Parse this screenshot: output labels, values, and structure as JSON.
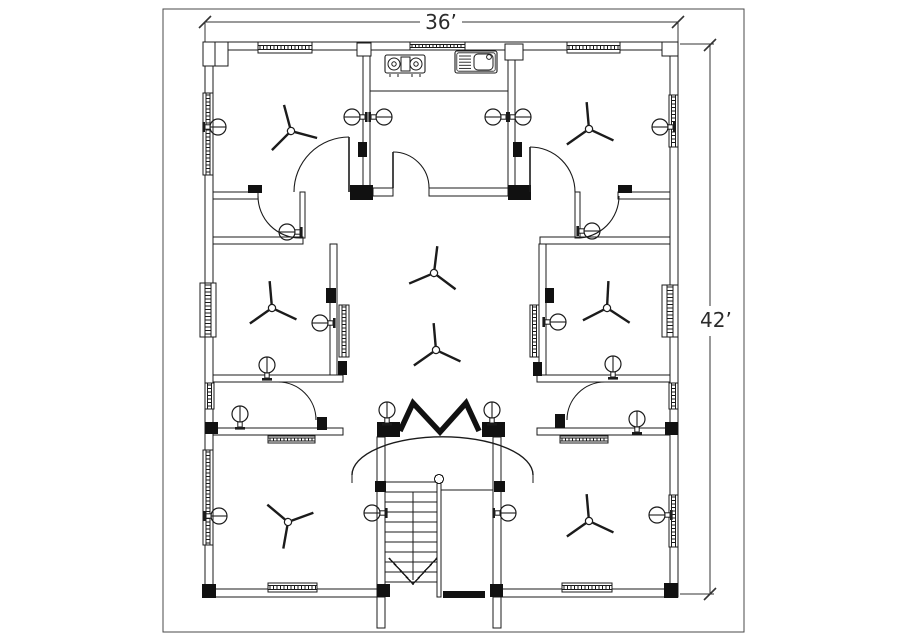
{
  "title": "Floor plan drawing",
  "dimensions": {
    "width_label": "36’",
    "height_label": "42’"
  },
  "colors": {
    "line": "#1b1b1b",
    "dim": "#333333",
    "border": "#4a4a4a",
    "fill": "#ffffff",
    "block": "#111111"
  },
  "plan": {
    "border": [
      163,
      9,
      581,
      623
    ],
    "dim_segments": [
      [
        205,
        22,
        420,
        22
      ],
      [
        462,
        22,
        678,
        22
      ],
      [
        710,
        45,
        710,
        306
      ],
      [
        710,
        336,
        710,
        594
      ]
    ],
    "dim_ticks": [
      [
        205,
        22
      ],
      [
        678,
        22
      ],
      [
        710,
        45
      ],
      [
        710,
        594
      ]
    ],
    "ext_lines": [
      [
        205,
        22,
        205,
        45
      ],
      [
        678,
        22,
        678,
        45
      ],
      [
        680,
        44,
        714,
        44
      ],
      [
        680,
        594,
        714,
        594
      ]
    ],
    "width_label_pos": [
      441,
      29
    ],
    "height_label_pos": [
      700,
      327
    ],
    "walls": [
      [
        205,
        42,
        473,
        8
      ],
      [
        205,
        589,
        180,
        8
      ],
      [
        493,
        589,
        185,
        8
      ],
      [
        205,
        42,
        8,
        555
      ],
      [
        670,
        42,
        8,
        555
      ],
      [
        363,
        50,
        7,
        138
      ],
      [
        508,
        50,
        7,
        138
      ],
      [
        373,
        188,
        20,
        8
      ],
      [
        429,
        188,
        79,
        8
      ],
      [
        213,
        192,
        45,
        7
      ],
      [
        618,
        192,
        52,
        7
      ],
      [
        300,
        192,
        5,
        46
      ],
      [
        575,
        192,
        5,
        46
      ],
      [
        213,
        237,
        90,
        7
      ],
      [
        540,
        237,
        130,
        7
      ],
      [
        330,
        244,
        7,
        131
      ],
      [
        539,
        244,
        7,
        131
      ],
      [
        213,
        375,
        130,
        7
      ],
      [
        537,
        375,
        133,
        7
      ],
      [
        213,
        428,
        130,
        7
      ],
      [
        537,
        428,
        133,
        7
      ],
      [
        377,
        437,
        8,
        160
      ],
      [
        493,
        437,
        8,
        160
      ],
      [
        377,
        597,
        8,
        31
      ],
      [
        493,
        597,
        8,
        31
      ],
      [
        437,
        479,
        4,
        118
      ]
    ],
    "lines": [
      [
        370,
        91,
        508,
        91
      ],
      [
        441,
        490,
        493,
        490
      ],
      [
        413,
        492,
        413,
        580
      ],
      [
        352,
        475,
        352,
        483
      ],
      [
        533,
        475,
        533,
        483
      ]
    ],
    "blocks": [
      [
        350,
        185,
        23,
        15
      ],
      [
        508,
        185,
        23,
        15
      ],
      [
        377,
        422,
        23,
        15
      ],
      [
        482,
        422,
        23,
        15
      ],
      [
        317,
        417,
        10,
        13
      ],
      [
        555,
        414,
        10,
        14
      ],
      [
        326,
        288,
        10,
        15
      ],
      [
        545,
        288,
        9,
        15
      ],
      [
        338,
        361,
        9,
        14
      ],
      [
        533,
        362,
        9,
        14
      ],
      [
        205,
        422,
        13,
        12
      ],
      [
        665,
        422,
        13,
        13
      ],
      [
        375,
        481,
        11,
        11
      ],
      [
        494,
        481,
        11,
        11
      ],
      [
        377,
        584,
        13,
        13
      ],
      [
        490,
        584,
        13,
        13
      ],
      [
        202,
        584,
        14,
        14
      ],
      [
        664,
        583,
        14,
        15
      ],
      [
        443,
        591,
        42,
        7
      ],
      [
        358,
        142,
        9,
        15
      ],
      [
        513,
        142,
        9,
        15
      ],
      [
        248,
        185,
        14,
        8
      ],
      [
        618,
        185,
        14,
        8
      ]
    ],
    "hollows": [
      [
        203,
        42,
        25,
        24
      ],
      [
        357,
        43,
        14,
        13
      ],
      [
        505,
        44,
        18,
        16
      ],
      [
        662,
        42,
        16,
        14
      ]
    ],
    "windows": [
      {
        "r": [
          258,
          42,
          54,
          11
        ],
        "o": "h"
      },
      {
        "r": [
          410,
          42,
          55,
          8
        ],
        "o": "h"
      },
      {
        "r": [
          567,
          42,
          53,
          11
        ],
        "o": "h"
      },
      {
        "r": [
          268,
          583,
          49,
          9
        ],
        "o": "h"
      },
      {
        "r": [
          562,
          583,
          50,
          9
        ],
        "o": "h"
      },
      {
        "r": [
          268,
          436,
          47,
          7
        ],
        "o": "h"
      },
      {
        "r": [
          560,
          436,
          48,
          7
        ],
        "o": "h"
      },
      {
        "r": [
          203,
          93,
          10,
          82
        ],
        "o": "v"
      },
      {
        "r": [
          200,
          283,
          16,
          54
        ],
        "o": "v"
      },
      {
        "r": [
          203,
          450,
          10,
          95
        ],
        "o": "v"
      },
      {
        "r": [
          205,
          383,
          9,
          26
        ],
        "o": "v"
      },
      {
        "r": [
          669,
          95,
          9,
          52
        ],
        "o": "v"
      },
      {
        "r": [
          662,
          285,
          16,
          52
        ],
        "o": "v"
      },
      {
        "r": [
          669,
          495,
          9,
          52
        ],
        "o": "v"
      },
      {
        "r": [
          669,
          383,
          9,
          26
        ],
        "o": "v"
      },
      {
        "r": [
          339,
          305,
          10,
          52
        ],
        "o": "v"
      },
      {
        "r": [
          530,
          305,
          9,
          52
        ],
        "o": "v"
      }
    ],
    "doors": [
      {
        "c": [
          393,
          188
        ],
        "r": 36,
        "a0": 270,
        "a1": 0,
        "sweep": 1,
        "leaf": [
          393,
          152,
          393,
          188
        ]
      },
      {
        "c": [
          349,
          192
        ],
        "r": 55,
        "a0": 270,
        "a1": 180,
        "sweep": 0,
        "leaf": [
          349,
          137,
          349,
          192
        ]
      },
      {
        "c": [
          530,
          192
        ],
        "r": 45,
        "a0": 270,
        "a1": 0,
        "sweep": 1,
        "leaf": [
          530,
          147,
          530,
          192
        ]
      },
      {
        "c": [
          300,
          196
        ],
        "r": 42,
        "a0": 180,
        "a1": 90,
        "sweep": 0,
        "leaf": null
      },
      {
        "c": [
          577,
          196
        ],
        "r": 42,
        "a0": 0,
        "a1": 90,
        "sweep": 1,
        "leaf": null
      },
      {
        "c": [
          278,
          420
        ],
        "r": 38,
        "a0": 270,
        "a1": 0,
        "sweep": 1,
        "leaf": null
      },
      {
        "c": [
          605,
          420
        ],
        "r": 38,
        "a0": 270,
        "a1": 180,
        "sweep": 0,
        "leaf": null
      }
    ],
    "arch": "M 352 475 A 90 38 0 0 1 533 475",
    "chevron": [
      [
        400,
        431
      ],
      [
        413,
        403
      ],
      [
        440,
        432
      ],
      [
        466,
        403
      ],
      [
        479,
        431
      ]
    ],
    "fans": [
      [
        291,
        131,
        350
      ],
      [
        589,
        129,
        0
      ],
      [
        272,
        308,
        0
      ],
      [
        607,
        308,
        8
      ],
      [
        434,
        273,
        12
      ],
      [
        436,
        350,
        0
      ],
      [
        288,
        522,
        195
      ],
      [
        589,
        521,
        0
      ]
    ],
    "lights": [
      [
        218,
        127,
        "W"
      ],
      [
        660,
        127,
        "E"
      ],
      [
        352,
        117,
        "E"
      ],
      [
        384,
        117,
        "W"
      ],
      [
        493,
        117,
        "E"
      ],
      [
        523,
        117,
        "W"
      ],
      [
        287,
        232,
        "E"
      ],
      [
        592,
        231,
        "W"
      ],
      [
        320,
        323,
        "E"
      ],
      [
        558,
        322,
        "W"
      ],
      [
        267,
        365,
        "S"
      ],
      [
        613,
        364,
        "S"
      ],
      [
        240,
        414,
        "S"
      ],
      [
        637,
        419,
        "S"
      ],
      [
        387,
        410,
        "S"
      ],
      [
        492,
        410,
        "S"
      ],
      [
        372,
        513,
        "E"
      ],
      [
        508,
        513,
        "W"
      ],
      [
        219,
        516,
        "W"
      ],
      [
        657,
        515,
        "E"
      ]
    ],
    "stove": {
      "x": 385,
      "y": 55,
      "w": 40,
      "h": 18,
      "burners": [
        [
          394,
          64
        ],
        [
          416,
          64
        ]
      ],
      "mid": [
        401,
        57,
        9,
        14
      ],
      "knobs": [
        390,
        398,
        412,
        420
      ],
      "knob_y": 74
    },
    "sink": {
      "x": 455,
      "y": 51,
      "w": 42,
      "h": 22,
      "basin": [
        474,
        54,
        19,
        16
      ],
      "tap": [
        489,
        57
      ],
      "drains": 5
    },
    "stairs": {
      "tread_x1": 385,
      "tread_x2": 437,
      "tread_y0": 482,
      "tread_dy": 10,
      "tread_n": 11,
      "newel": [
        439,
        479
      ],
      "arrow": [
        [
          389,
          558
        ],
        [
          413,
          584
        ],
        [
          437,
          558
        ]
      ]
    }
  }
}
